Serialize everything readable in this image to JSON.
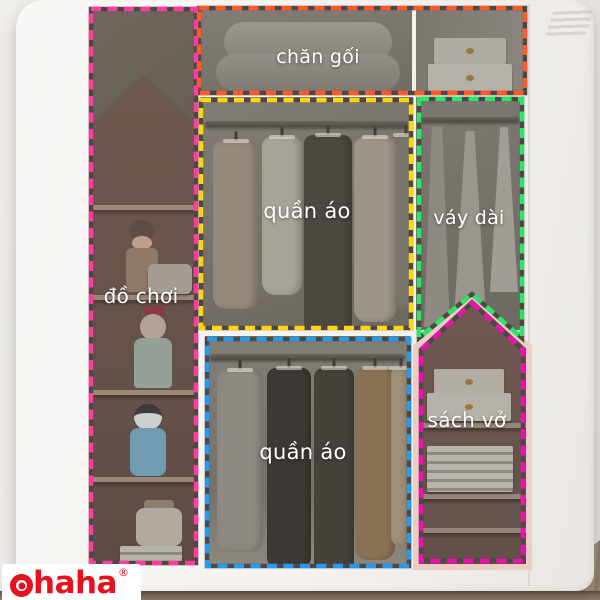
{
  "zones": [
    {
      "id": "chan-goi",
      "label": "chăn gối",
      "color": "#ff5a2b"
    },
    {
      "id": "do-choi",
      "label": "đồ chơi",
      "color": "#ff3d9e"
    },
    {
      "id": "quan-ao-tren",
      "label": "quần áo",
      "color": "#ffd60a"
    },
    {
      "id": "vay-dai",
      "label": "váy dài",
      "color": "#2ee36a"
    },
    {
      "id": "quan-ao-duoi",
      "label": "quần áo",
      "color": "#2799ee"
    },
    {
      "id": "sach-vo",
      "label": "sách vở",
      "color": "#f00fb0"
    }
  ],
  "dash": {
    "underlay_color": "#4d4843"
  },
  "house_frame": {
    "color": "#edccc8"
  },
  "brand": {
    "name": "Ohaha",
    "rest": "haha",
    "registered": "®",
    "color": "#e8101c"
  }
}
